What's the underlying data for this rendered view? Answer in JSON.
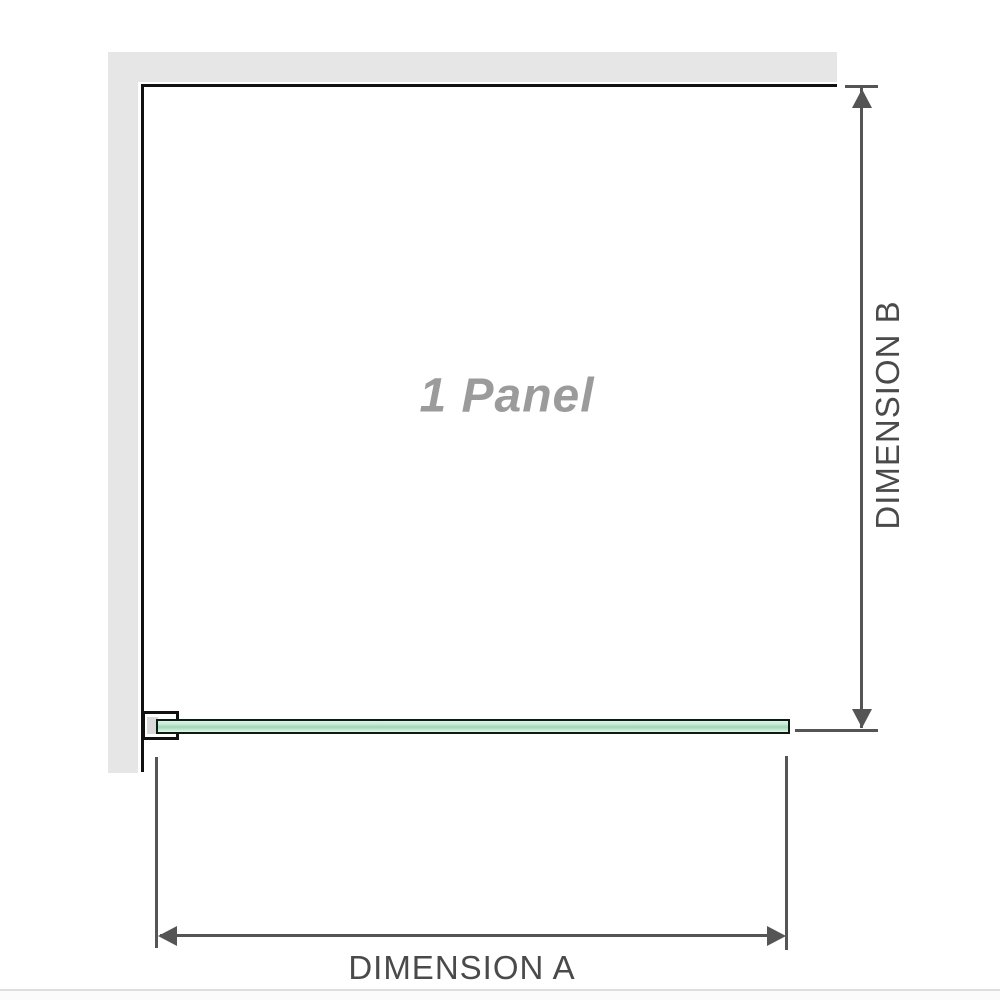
{
  "diagram": {
    "panel_label": "1 Panel",
    "dimension_a_label": "DIMENSION A",
    "dimension_b_label": "DIMENSION B",
    "colors": {
      "wall": "#e6e6e6",
      "outline": "#111111",
      "glass_mid": "#9ed6b8",
      "dimension": "#555555",
      "label_text": "#4a4a4a",
      "panel_text": "#9b9b9b",
      "bracket_fill": "#ffffff",
      "bracket_block": "#d9d9d9",
      "baseline": "#dedede"
    }
  }
}
